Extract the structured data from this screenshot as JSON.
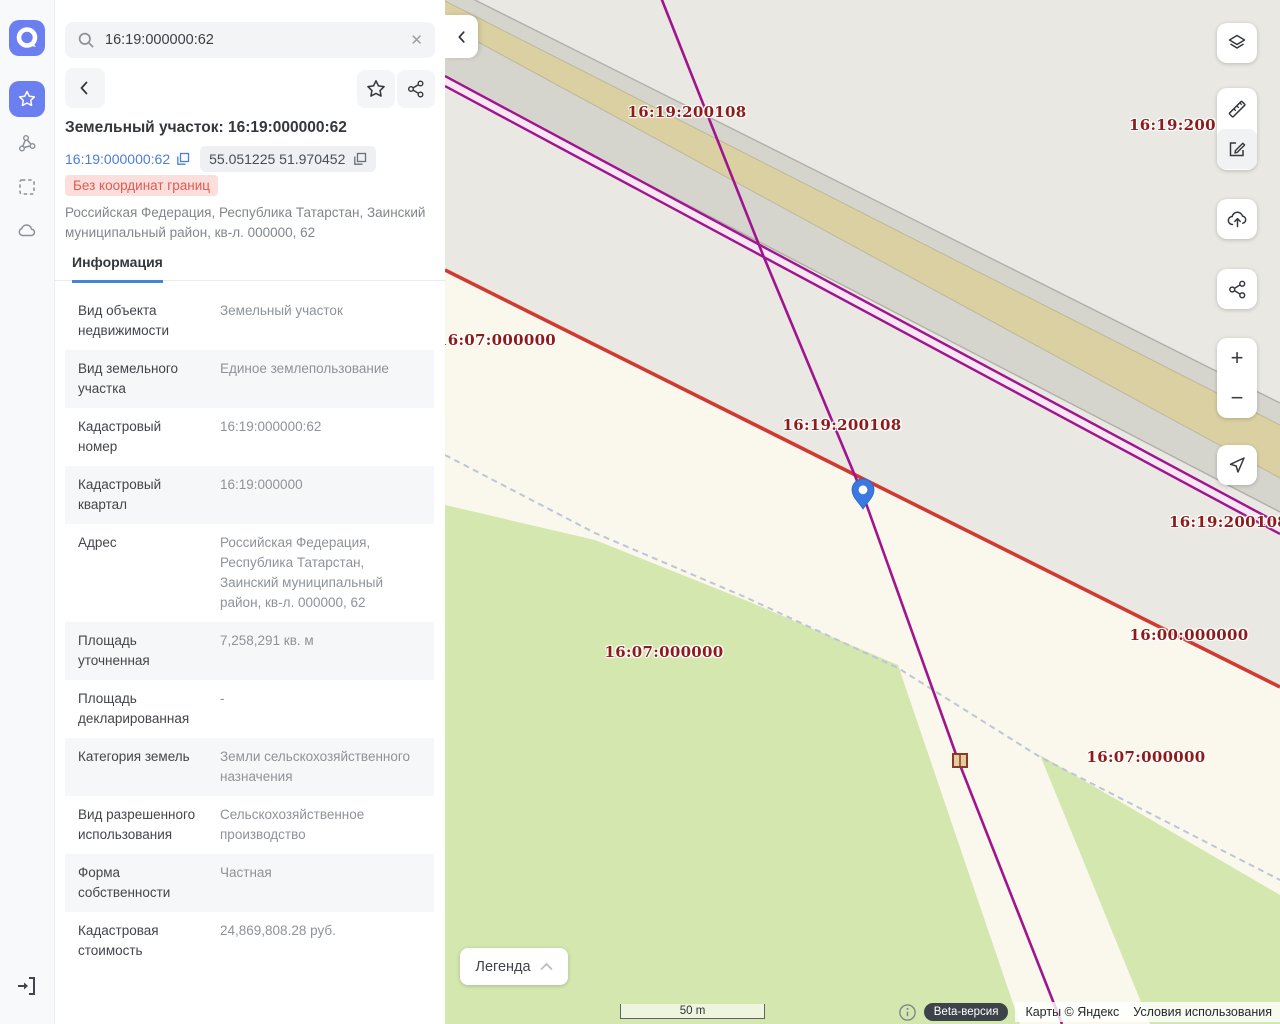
{
  "sidebar": {
    "logo": "a",
    "items": [
      "favorites",
      "objects",
      "area-select",
      "cloud"
    ],
    "exit": "exit"
  },
  "search": {
    "value": "16:19:000000:62"
  },
  "detail": {
    "title": "Земельный участок: 16:19:000000:62",
    "cad_number_link": "16:19:000000:62",
    "coordinates": "55.051225 51.970452",
    "badge": "Без координат границ",
    "address": "Российская Федерация, Республика Татарстан, Заинский муниципальный район, кв-л. 000000, 62",
    "tab": "Информация",
    "rows": [
      {
        "label": "Вид объекта недвижимости",
        "value": "Земельный участок"
      },
      {
        "label": "Вид земельного участка",
        "value": "Единое землепользование"
      },
      {
        "label": "Кадастровый номер",
        "value": "16:19:000000:62"
      },
      {
        "label": "Кадастровый квартал",
        "value": "16:19:000000"
      },
      {
        "label": "Адрес",
        "value": "Российская Федерация, Республика Татарстан, Заинский муниципальный район, кв-л. 000000, 62"
      },
      {
        "label": "Площадь уточненная",
        "value": "7,258,291 кв. м"
      },
      {
        "label": "Площадь декларированная",
        "value": "-"
      },
      {
        "label": "Категория земель",
        "value": "Земли сельскохозяйственного назначения"
      },
      {
        "label": "Вид разрешенного использования",
        "value": "Сельскохозяйственное производство"
      },
      {
        "label": "Форма собственности",
        "value": "Частная"
      },
      {
        "label": "Кадастровая стоимость",
        "value": "24,869,808.28 руб."
      }
    ]
  },
  "map": {
    "labels": [
      {
        "text": "16:19:200108",
        "x": 242,
        "y": 112
      },
      {
        "text": "16:19:200108",
        "x": 684,
        "y": 125,
        "anchor": "left"
      },
      {
        "text": "16:07:000000",
        "x": -8,
        "y": 340,
        "anchor": "left"
      },
      {
        "text": "16:19:200108",
        "x": 397,
        "y": 425
      },
      {
        "text": "16:19:200108",
        "x": 724,
        "y": 522,
        "anchor": "left"
      },
      {
        "text": "16:00:000000",
        "x": 744,
        "y": 635
      },
      {
        "text": "16:07:000000",
        "x": 219,
        "y": 652
      },
      {
        "text": "16:07:000000",
        "x": 701,
        "y": 757
      }
    ],
    "legend_label": "Легенда",
    "scale_label": "50 m",
    "attribution": {
      "beta": "Beta-версия",
      "maps": "Карты © Яндекс",
      "terms": "Условия использования"
    },
    "colors": {
      "accent_blue": "#6b7ff0",
      "link_blue": "#4a7fd4",
      "badge_bg": "#fcdfdd",
      "badge_text": "#e25950",
      "label_red": "#8e1b1b",
      "parcel_purple": "#a0148e",
      "boundary_red": "#d03a30",
      "field_green": "#d3e7af",
      "cream": "#faf8ec",
      "base_beige": "#e9e8e2",
      "road_gray": "#d5d5ce",
      "road_tan": "#dbd0a2",
      "pin_blue": "#3b78e0"
    }
  }
}
